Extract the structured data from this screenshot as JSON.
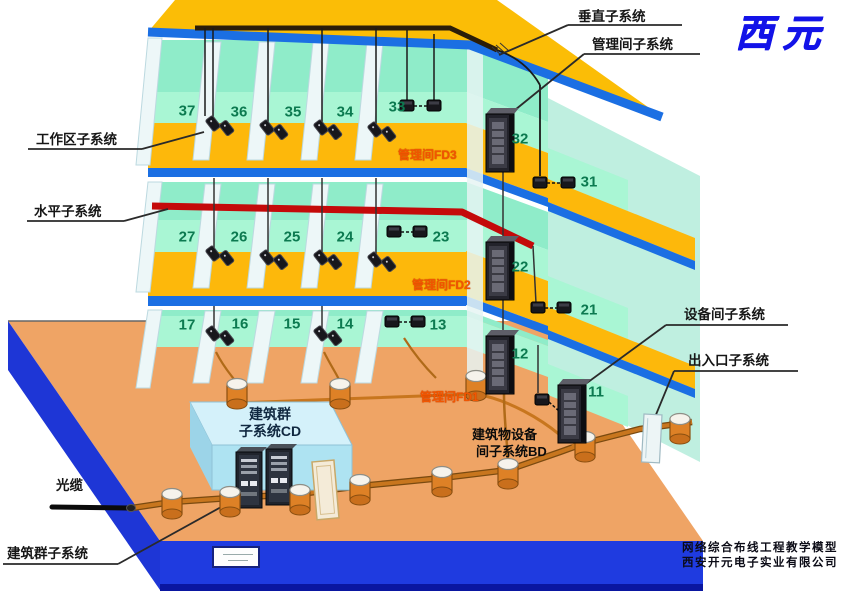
{
  "logo": "西元",
  "labels": {
    "vertical_subsystem": "垂直子系统",
    "management_room_subsystem": "管理间子系统",
    "work_area_subsystem": "工作区子系统",
    "horizontal_subsystem": "水平子系统",
    "equipment_room_subsystem": "设备间子系统",
    "entrance_subsystem": "出入口子系统",
    "optical_cable": "光缆",
    "campus_subsystem": "建筑群子系统"
  },
  "floor_tags": {
    "fd3": "管理间FD3",
    "fd2": "管理间FD2",
    "fd1": "管理间FD1"
  },
  "cd_box": {
    "line1": "建筑群",
    "line2": "子系统CD"
  },
  "bd_label": {
    "line1": "建筑物设备",
    "line2": "间子系统BD"
  },
  "rooms": {
    "f3": [
      "37",
      "36",
      "35",
      "34",
      "33",
      "32",
      "31"
    ],
    "f2": [
      "27",
      "26",
      "25",
      "24",
      "23",
      "22",
      "21"
    ],
    "f1": [
      "17",
      "16",
      "15",
      "14",
      "13",
      "12",
      "11"
    ]
  },
  "footer": {
    "line1": "网络综合布线工程教学模型",
    "line2": "西安开元电子实业有限公司"
  },
  "colors": {
    "floor_yellow": "#FDB80B",
    "edge_blue": "#1B6FE3",
    "platform_blue": "#1F3BE0",
    "ground_orange": "#EFA465",
    "wall_teal": "#8FECC9",
    "band_mint": "#A9F6D4",
    "cable_red": "#C40A0A",
    "conduit_orange": "#C8761E",
    "floor_tag_orange": "#F25600",
    "logo_blue": "#1313E8",
    "room_number_green": "#0C7A50"
  }
}
